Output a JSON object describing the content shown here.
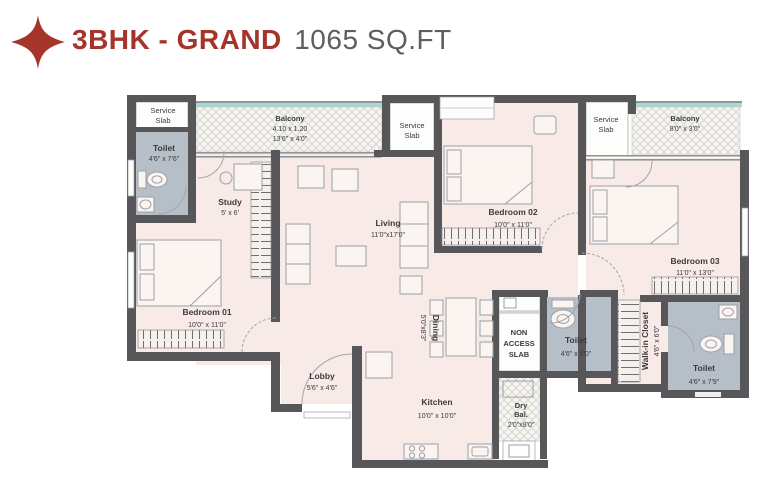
{
  "header": {
    "title": "3BHK - GRAND",
    "area": "1065 SQ.FT",
    "accent_color": "#A5342B",
    "area_color": "#5d5e60"
  },
  "colors": {
    "wall": "#57575a",
    "room_fill": "#f8eae7",
    "wet_fill": "#b6bec8",
    "balcony_window": "#a7d8d2"
  },
  "rooms": {
    "service_slab_left": {
      "line1": "Service",
      "line2": "Slab"
    },
    "toilet_top_left": {
      "name": "Toilet",
      "dims": "4'6\" x 7'6\""
    },
    "balcony_top": {
      "name": "Balcony",
      "dims_m": "4.10 x 1.20",
      "dims": "13'6\" x 4'0\""
    },
    "study": {
      "name": "Study",
      "dims": "5' x 6'"
    },
    "service_slab_mid": {
      "line1": "Service",
      "line2": "Slab"
    },
    "living": {
      "name": "Living",
      "dims": "11'0\"x17'0\""
    },
    "bedroom02": {
      "name": "Bedroom 02",
      "dims": "10'0\" x 11'0\""
    },
    "service_slab_right": {
      "line1": "Service",
      "line2": "Slab"
    },
    "balcony_right": {
      "name": "Balcony",
      "dims": "8'0\" x 3'0\""
    },
    "bedroom03": {
      "name": "Bedroom 03",
      "dims": "11'0\" x 13'0\""
    },
    "bedroom01": {
      "name": "Bedroom 01",
      "dims": "10'0\" x 11'0\""
    },
    "lobby": {
      "name": "Lobby",
      "dims": "5'6\" x 4'6\""
    },
    "dining": {
      "name": "Dining",
      "dims": "5'0\"x8'3\""
    },
    "kitchen": {
      "name": "Kitchen",
      "dims": "10'0\" x 10'0\""
    },
    "non_access_slab": {
      "line1": "NON",
      "line2": "ACCESS",
      "line3": "SLAB"
    },
    "toilet_mid": {
      "name": "Toilet",
      "dims": "4'6\" x 6'0\""
    },
    "walk_in_closet": {
      "name": "Walk-in Closet",
      "dims": "4'6\" x 6'0\""
    },
    "toilet_right": {
      "name": "Toilet",
      "dims": "4'6\" x 7'9\""
    },
    "dry_balcony": {
      "line1": "Dry",
      "line2": "Bal.",
      "dims": "2'0\"x8'0\""
    }
  }
}
